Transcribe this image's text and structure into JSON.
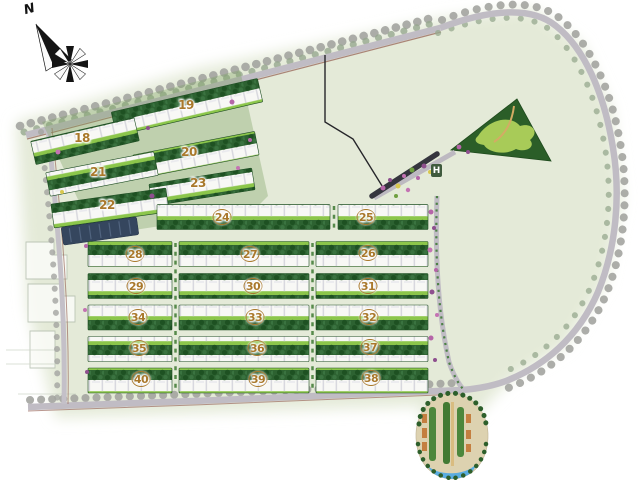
{
  "map": {
    "compass": {
      "label": "N"
    },
    "entrance_marker": {
      "label": "H"
    },
    "blocks": [
      {
        "label": "18",
        "x": 82,
        "y": 138,
        "circled": false
      },
      {
        "label": "19",
        "x": 186,
        "y": 105,
        "circled": false
      },
      {
        "label": "20",
        "x": 189,
        "y": 152,
        "circled": false
      },
      {
        "label": "21",
        "x": 98,
        "y": 172,
        "circled": false
      },
      {
        "label": "22",
        "x": 107,
        "y": 205,
        "circled": false
      },
      {
        "label": "23",
        "x": 198,
        "y": 183,
        "circled": false
      },
      {
        "label": "24",
        "x": 222,
        "y": 217,
        "circled": true
      },
      {
        "label": "25",
        "x": 366,
        "y": 217,
        "circled": true
      },
      {
        "label": "26",
        "x": 368,
        "y": 253,
        "circled": true
      },
      {
        "label": "27",
        "x": 250,
        "y": 254,
        "circled": true
      },
      {
        "label": "28",
        "x": 135,
        "y": 254,
        "circled": true
      },
      {
        "label": "29",
        "x": 136,
        "y": 286,
        "circled": true
      },
      {
        "label": "30",
        "x": 253,
        "y": 286,
        "circled": true
      },
      {
        "label": "31",
        "x": 368,
        "y": 286,
        "circled": true
      },
      {
        "label": "32",
        "x": 369,
        "y": 317,
        "circled": true
      },
      {
        "label": "33",
        "x": 255,
        "y": 317,
        "circled": true
      },
      {
        "label": "34",
        "x": 138,
        "y": 317,
        "circled": true
      },
      {
        "label": "35",
        "x": 139,
        "y": 348,
        "circled": true
      },
      {
        "label": "36",
        "x": 257,
        "y": 348,
        "circled": true
      },
      {
        "label": "37",
        "x": 370,
        "y": 347,
        "circled": true
      },
      {
        "label": "38",
        "x": 371,
        "y": 378,
        "circled": true
      },
      {
        "label": "39",
        "x": 258,
        "y": 379,
        "circled": true
      },
      {
        "label": "40",
        "x": 141,
        "y": 379,
        "circled": true
      }
    ],
    "colors": {
      "label_gold": "#a9782b",
      "residential_green": "#2d6231",
      "lawn_green": "#8cc64b",
      "road_gray": "#c0bcc4",
      "park_green": "#2b5e28",
      "water_blue": "#5aace0",
      "site_background": "#e4ead8",
      "flower_pink": "#b565a8",
      "compass_black": "#141414"
    }
  }
}
